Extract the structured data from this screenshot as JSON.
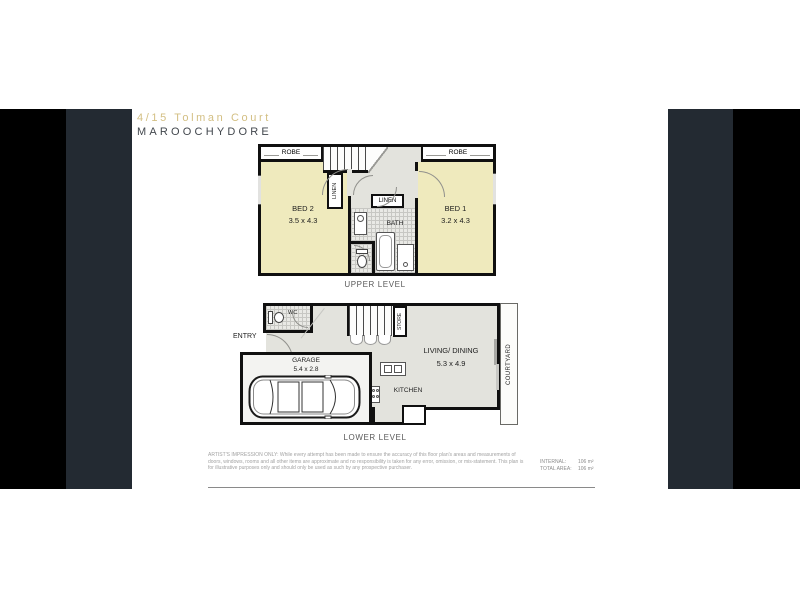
{
  "header": {
    "title": "4/15 Tolman Court",
    "suburb": "MAROOCHYDORE"
  },
  "upper": {
    "caption": "UPPER LEVEL",
    "bed2_name": "BED 2",
    "bed2_dims": "3.5 x 4.3",
    "bed1_name": "BED 1",
    "bed1_dims": "3.2 x 4.3",
    "robe_left": "ROBE",
    "robe_right": "ROBE",
    "linen_closet": "LINEN",
    "linen_hall": "LINEN",
    "bath": "BATH"
  },
  "lower": {
    "caption": "LOWER LEVEL",
    "entry": "ENTRY",
    "wc": "WC",
    "store": "STORE",
    "garage_name": "GARAGE",
    "garage_dims": "5.4 x 2.8",
    "living_name": "LIVING/ DINING",
    "living_dims": "5.3 x 4.9",
    "kitchen": "KITCHEN",
    "courtyard": "COURTYARD"
  },
  "footer": {
    "disclaimer": "ARTIST'S IMPRESSION ONLY: While every attempt has been made to ensure the accuracy of this floor plan's areas and measurements of doors, windows, rooms and all other items are approximate and no responsibility is taken for any error, omission, or mis-statement. This plan is for illustrative purposes only and should only be used as such by any prospective purchaser.",
    "internal_label": "INTERNAL:",
    "internal_value": "106 m²",
    "total_label": "TOTAL AREA:",
    "total_value": "106 m²"
  },
  "colors": {
    "accent_gold": "#d3bf83",
    "bar_charcoal": "#232a32",
    "bar_black": "#000000",
    "room_yellow": "#efeabd",
    "floor_grey": "#e3e3dd",
    "wall": "#101010"
  }
}
